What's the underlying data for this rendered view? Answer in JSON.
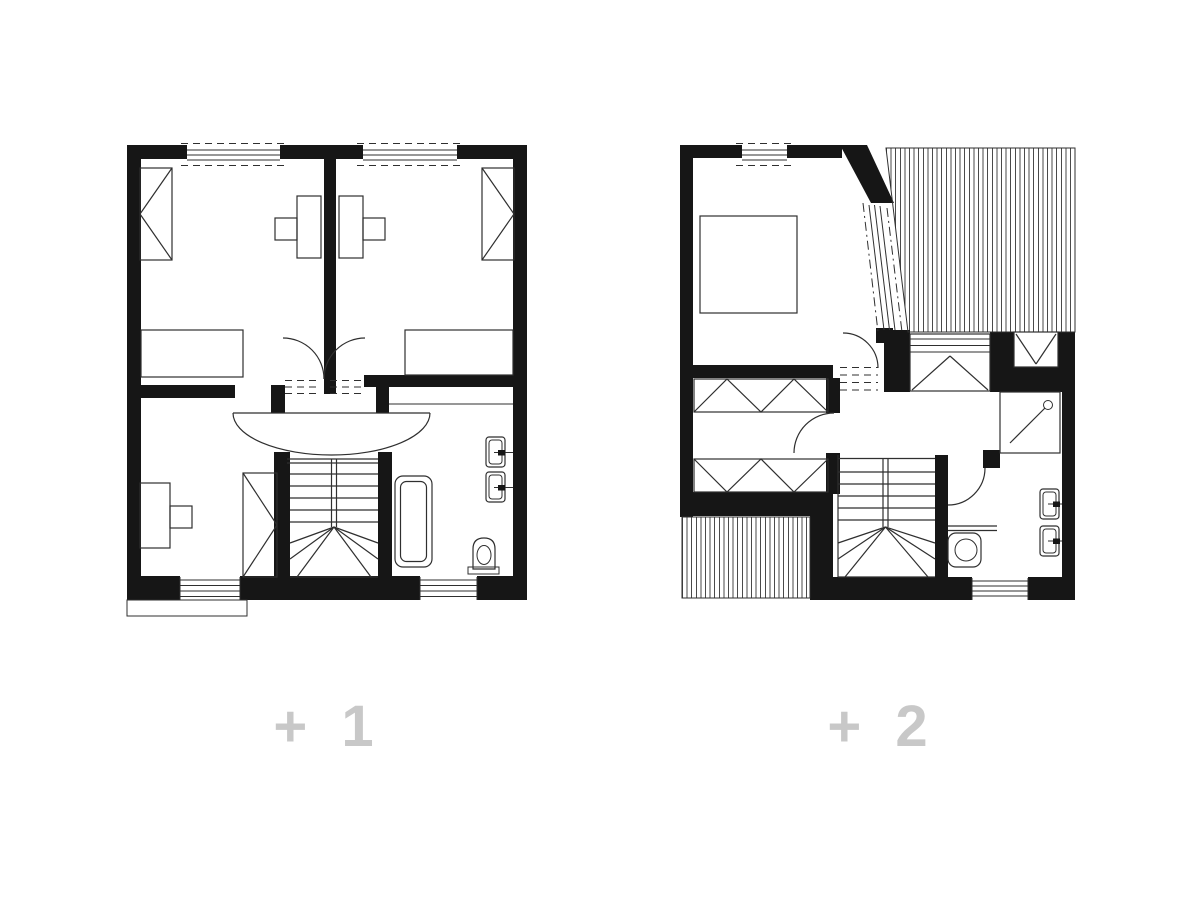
{
  "figure": {
    "type": "architectural-floor-plan-pair",
    "plans": [
      {
        "id": "level-plus-1",
        "label": "+ 1"
      },
      {
        "id": "level-plus-2",
        "label": "+ 2"
      }
    ],
    "colors": {
      "background": "#ffffff",
      "walls": "#161616",
      "linework": "#2f2f2f",
      "hatch": "#4a4a4a",
      "floor_label": "#c8c8c8"
    }
  }
}
